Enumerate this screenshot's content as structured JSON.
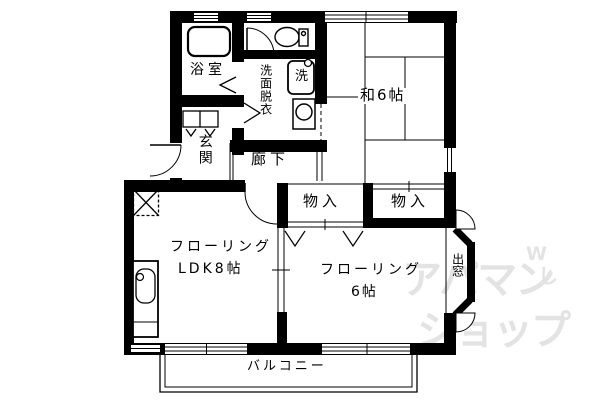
{
  "colors": {
    "wall": "#000000",
    "background": "#ffffff",
    "watermark": "#e3e3e3"
  },
  "labels": {
    "bath": "浴室",
    "washroom": "洗面脱衣",
    "laundry": "洗",
    "japanese_room": "和6帖",
    "entrance": "玄関",
    "hallway": "廊下",
    "closet_left": "物入",
    "closet_right": "物入",
    "ldk_line1": "フローリング",
    "ldk_line2": "LDK8帖",
    "western_line1": "フローリング",
    "western_line2": "6帖",
    "bay_window": "出窓",
    "balcony": "バルコニー"
  },
  "watermark": {
    "line1": "アパマン",
    "mark_w": "W",
    "mark_shi": "し",
    "line2": "ショップ"
  }
}
